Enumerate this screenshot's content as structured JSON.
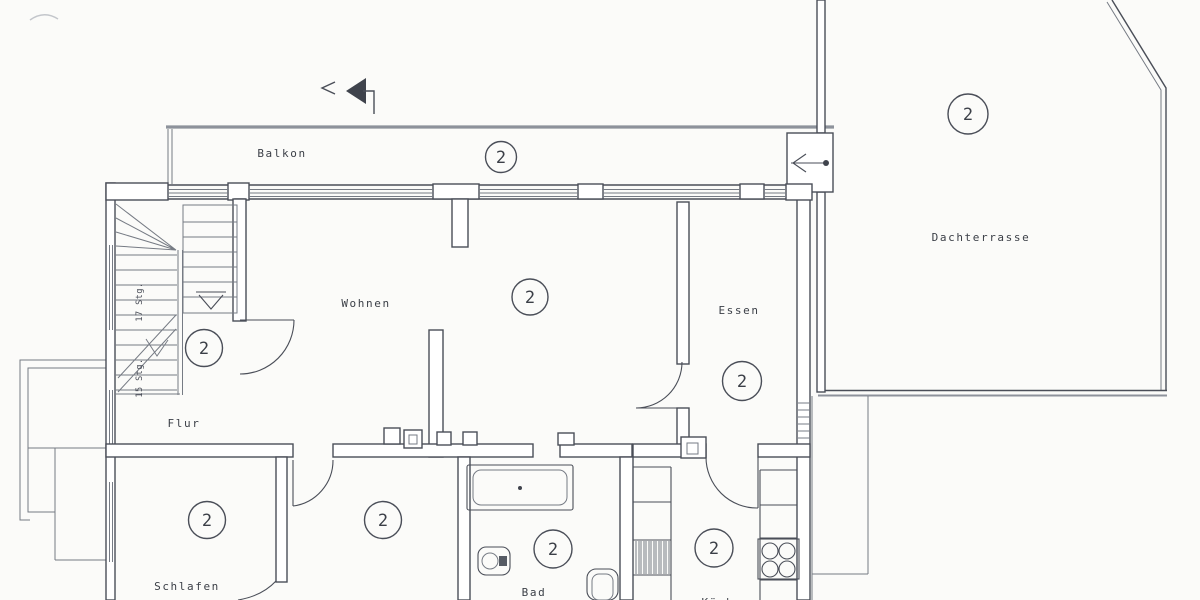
{
  "document": {
    "type": "scanned-floor-plan",
    "unit_number": "2",
    "rooms": {
      "balkon": "Balkon",
      "dachterrasse": "Dachterrasse",
      "wohnen": "Wohnen",
      "essen": "Essen",
      "flur": "Flur",
      "schlafen": "Schlafen",
      "bad": "Bad",
      "kueche": "Küche"
    },
    "stairs": {
      "upper_flight": "17 Stg.",
      "lower_flight": "15 Stg."
    },
    "colors": {
      "wall_line": "#4a4e58",
      "thin_line": "#767b84",
      "light_line": "#8d929b",
      "text": "#3b3f47",
      "paper": "#fbfbf9"
    }
  }
}
